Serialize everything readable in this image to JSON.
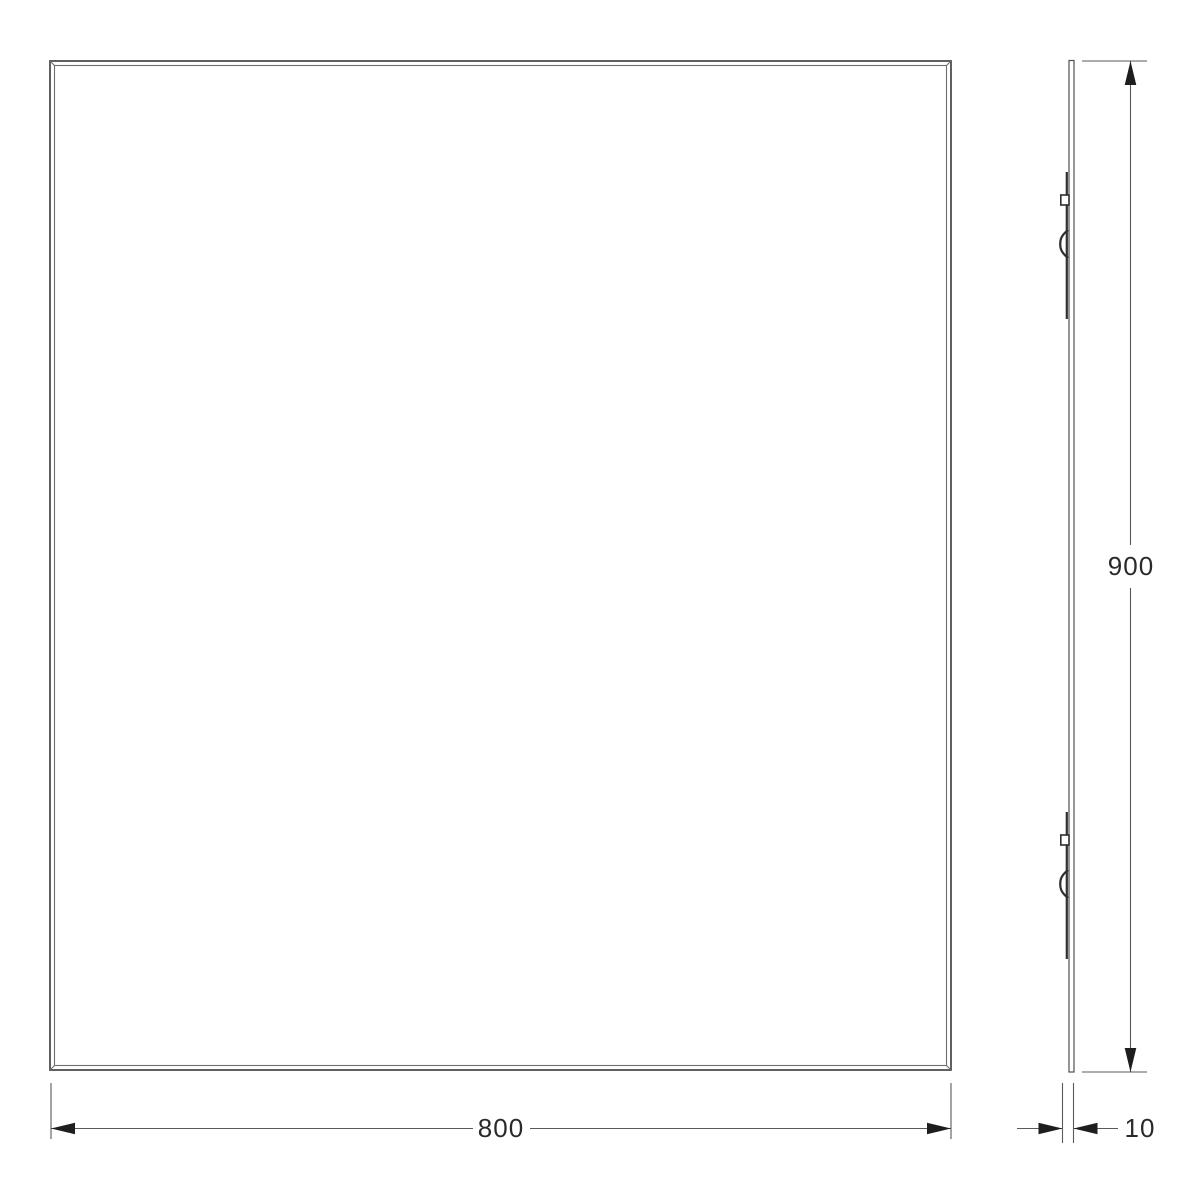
{
  "canvas": {
    "background": "#ffffff"
  },
  "colors": {
    "outline": "#4f4f4f",
    "inner_line": "#6e6e6e",
    "panel_line": "#4f4f4f",
    "bracket": "#2f2f2f",
    "dimension_line": "#5a5a5a",
    "arrow": "#1e1e1e",
    "text": "#2a2a2a"
  },
  "dimensions": {
    "width_label": "800",
    "height_label": "900",
    "depth_label": "10"
  }
}
